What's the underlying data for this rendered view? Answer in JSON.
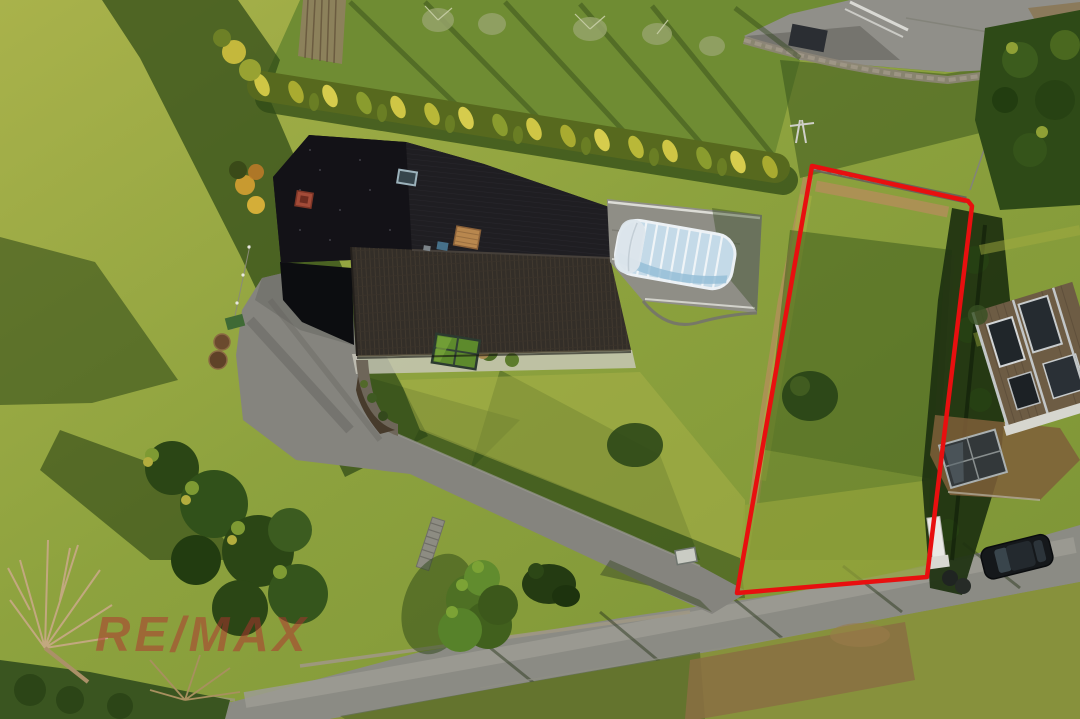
{
  "photo": {
    "kind": "aerial-drone-photograph",
    "description": "Top-down drone view of a hillside property: dark-roofed house with covered swimming pool, curved driveway, lawns, cypress hedge row, access road with parked car, and an adjacent building plot outlined in red",
    "width_px": 1080,
    "height_px": 719
  },
  "watermark": {
    "text": "RE/MAX",
    "color": "#b23130",
    "opacity": "0.5"
  },
  "boundary": {
    "label": "building-plot-outline",
    "points": "812,166 968,201 972,206 927,577 737,593",
    "color": "#e80f0f",
    "width": "4.5"
  },
  "palette": {
    "grass_sunlit": "#a8b14a",
    "grass_mid": "#86993a",
    "grass_shadow": "#2b4616",
    "roof_dark": "#1b1a1e",
    "roof_tiles": "#332e28",
    "asphalt": "#86857f",
    "road": "#8b8b84",
    "pool_cover_blue": "#c4dae8",
    "hedge_gold": "#cfc645",
    "dirt_tan": "#b3905a",
    "stone_wall": "#8d8577",
    "car_black": "#15181b",
    "neighbor_wood": "#6d5c44"
  },
  "scene": {
    "labels": [
      "main-house-roof",
      "covered-swimming-pool",
      "driveway",
      "access-road",
      "cypress-hedge-row",
      "building-plot",
      "boundary-trees",
      "neighbor-house",
      "parked-car",
      "conifer-trees",
      "bare-tree",
      "orchard",
      "watermark"
    ]
  }
}
